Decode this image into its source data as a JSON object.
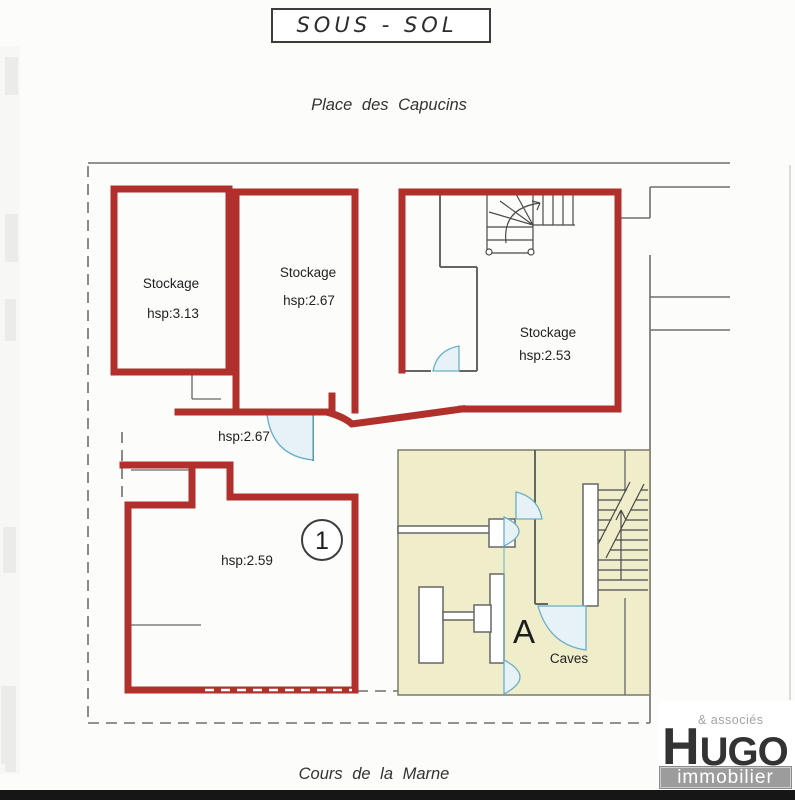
{
  "title": "SOUS - SOL",
  "streets": {
    "top": "Place des Capucins",
    "bottom": "Cours de la Marne"
  },
  "rooms": {
    "stockage1": {
      "name": "Stockage",
      "height": "hsp:3.13"
    },
    "stockage2": {
      "name": "Stockage",
      "height": "hsp:2.67"
    },
    "stockage3": {
      "name": "Stockage",
      "height": "hsp:2.53"
    },
    "corridor": {
      "height": "hsp:2.67"
    },
    "main_room": {
      "height": "hsp:2.59",
      "number": "1"
    },
    "caves": {
      "unit_letter": "A",
      "label": "Caves"
    }
  },
  "logo": {
    "suffix": "& associés",
    "brand_first_letter": "H",
    "brand_rest": "UGO",
    "tagline": "immobilier"
  },
  "colors": {
    "wall": "#b1302c",
    "partition": "#666666",
    "boundary": "#6f6f6f",
    "caves_fill": "#f0edcb",
    "door": "#6aaec6",
    "door_fill": "#e7f2f7",
    "logo_gray": "#9c9c9c",
    "logo_ink": "#333333"
  }
}
